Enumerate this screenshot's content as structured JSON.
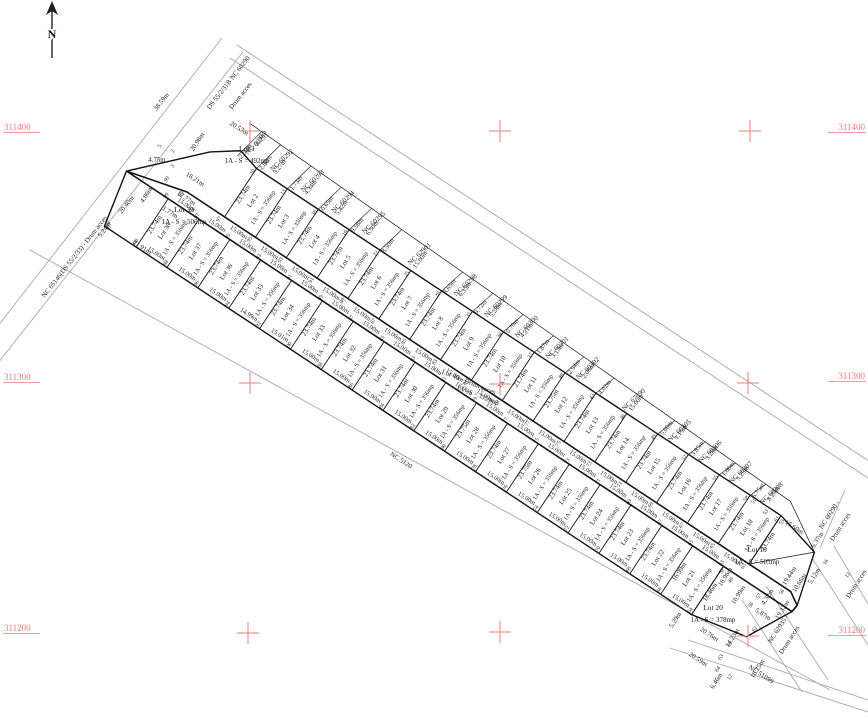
{
  "map": {
    "title": "Cadastral parcel plan",
    "north_label": "N",
    "colors": {
      "red": "#e87e7e",
      "line": "#1a1a1a",
      "faint": "#a8a8a8"
    },
    "grid": {
      "left_labels": [
        {
          "t": "311400",
          "y": 130
        },
        {
          "t": "311300",
          "y": 380
        },
        {
          "t": "311200",
          "y": 631
        }
      ],
      "right_labels": [
        {
          "t": "311400",
          "y": 130
        },
        {
          "t": "311300",
          "y": 379
        },
        {
          "t": "311200",
          "y": 633
        }
      ],
      "crosses": [
        [
          250,
          131
        ],
        [
          500,
          131
        ],
        [
          750,
          131
        ],
        [
          250,
          383
        ],
        [
          500,
          384
        ],
        [
          748,
          383
        ],
        [
          248,
          633
        ],
        [
          500,
          632
        ],
        [
          748,
          636
        ]
      ]
    },
    "central_road": {
      "name": "Lot 40 - Drum acces",
      "area": "1A - S = 3359mp",
      "label_pos": {
        "sx": 468,
        "sy": 384,
        "r": 22
      },
      "area_pos": {
        "sx": 477,
        "sy": 397,
        "r": 22
      }
    },
    "lots_top": [
      {
        "name": "Lot 1",
        "area": "1A - S = 492mp",
        "w": 45,
        "side": "20.98m",
        "front": "18.21m",
        "special": true,
        "lx": 247,
        "ly": 151
      },
      {
        "name": "Lot 2",
        "area": "1A - S = 356mp",
        "w": 37,
        "side": "23.74m",
        "front": "15.00m"
      },
      {
        "name": "Lot 3",
        "area": "1A - S = 356mp",
        "w": 37,
        "side": "23.74m",
        "front": "15.00m"
      },
      {
        "name": "Lot 4",
        "area": "1A - S = 356mp",
        "w": 37,
        "side": "23.74m",
        "front": "15.00m"
      },
      {
        "name": "Lot 5",
        "area": "1A - S = 356mp",
        "w": 37,
        "side": "23.74m",
        "front": "15.00m"
      },
      {
        "name": "Lot 6",
        "area": "1A - S = 356mp",
        "w": 37,
        "side": "23.74m",
        "front": "15.00m"
      },
      {
        "name": "Lot 7",
        "area": "1A - S = 356mp",
        "w": 37,
        "side": "23.74m",
        "front": "15.00m"
      },
      {
        "name": "Lot 8",
        "area": "1A - S = 356mp",
        "w": 37,
        "side": "23.74m",
        "front": "15.00m"
      },
      {
        "name": "Lot 9",
        "area": "1A - S = 356mp",
        "w": 37,
        "side": "23.74m",
        "front": "15.00m"
      },
      {
        "name": "Lot 10",
        "area": "1A - S = 356mp",
        "w": 37,
        "side": "23.74m",
        "front": "15.00m"
      },
      {
        "name": "Lot 11",
        "area": "1A - S = 356mp",
        "w": 37,
        "side": "23.74m",
        "front": "15.00m"
      },
      {
        "name": "Lot 12",
        "area": "1A - S = 356mp",
        "w": 37,
        "side": "23.75m",
        "front": "15.00m"
      },
      {
        "name": "Lot 13",
        "area": "1A - S = 356mp",
        "w": 37,
        "side": "23.74m",
        "front": "15.00m"
      },
      {
        "name": "Lot 14",
        "area": "1A - S = 356mp",
        "w": 37,
        "side": "23.74m",
        "front": "15.00m"
      },
      {
        "name": "Lot 15",
        "area": "1A - S = 356mp",
        "w": 37,
        "side": "23.74m",
        "front": "15.00m"
      },
      {
        "name": "Lot 16",
        "area": "1A - S = 356mp",
        "w": 37,
        "side": "23.74m",
        "front": "15.00m"
      },
      {
        "name": "Lot 17",
        "area": "1A - S = 356mp",
        "w": 37,
        "side": "23.74m",
        "front": "15.00m"
      },
      {
        "name": "Lot 18",
        "area": "1A - S = 356mp",
        "w": 37,
        "side": "23.74m",
        "front": "15.00m"
      },
      {
        "name": "Lot 19",
        "area": "1A - S = 505mp",
        "w": 50,
        "side": "23.74m",
        "front": "15.60m",
        "special": true,
        "lx": 757,
        "ly": 552
      }
    ],
    "lots_bottom": [
      {
        "name": "Lot 39",
        "area": "1A - S = 506mp",
        "w": 50,
        "side": "20.40m",
        "rear": "21.91m",
        "special": true,
        "lx": 184,
        "ly": 212
      },
      {
        "name": "Lot 38",
        "area": "1A - S = 356mp",
        "w": 37,
        "side": "23.74m",
        "rear": "15.00m"
      },
      {
        "name": "Lot 37",
        "area": "1A - S = 356mp",
        "w": 37,
        "side": "23.74m",
        "rear": "15.00m"
      },
      {
        "name": "Lot 36",
        "area": "1A - S = 356mp",
        "w": 37,
        "side": "23.74m",
        "rear": "15.00m"
      },
      {
        "name": "Lot 35",
        "area": "1A - S = 356mp",
        "w": 37,
        "side": "23.74m",
        "rear": "14.99m"
      },
      {
        "name": "Lot 34",
        "area": "1A - S = 356mp",
        "w": 37,
        "side": "23.74m",
        "rear": "15.01m"
      },
      {
        "name": "Lot 33",
        "area": "1A - S = 356mp",
        "w": 37,
        "side": "23.74m",
        "rear": "15.00m"
      },
      {
        "name": "Lot 32",
        "area": "1A - S = 356mp",
        "w": 37,
        "side": "23.74m",
        "rear": "15.00m"
      },
      {
        "name": "Lot 31",
        "area": "1A - S = 356mp",
        "w": 37,
        "side": "23.74m",
        "rear": "15.00m"
      },
      {
        "name": "Lot 30",
        "area": "1A - S = 356mp",
        "w": 37,
        "side": "23.74m",
        "rear": "15.00m"
      },
      {
        "name": "Lot 29",
        "area": "1A - S = 356mp",
        "w": 37,
        "side": "23.74m",
        "rear": "15.00m"
      },
      {
        "name": "Lot 28",
        "area": "1A - S = 356mp",
        "w": 37,
        "side": "23.75m",
        "rear": "15.00m"
      },
      {
        "name": "Lot 27",
        "area": "1A - S = 356mp",
        "w": 37,
        "side": "23.74m",
        "rear": "15.00m"
      },
      {
        "name": "Lot 26",
        "area": "1A - S = 356mp",
        "w": 37,
        "side": "23.75m",
        "rear": "15.00m"
      },
      {
        "name": "Lot 25",
        "area": "1A - S = 356mp",
        "w": 37,
        "side": "23.74m",
        "rear": "15.00m"
      },
      {
        "name": "Lot 24",
        "area": "1A - S = 356mp",
        "w": 37,
        "side": "23.74m",
        "rear": "15.00m"
      },
      {
        "name": "Lot 23",
        "area": "1A - S = 356mp",
        "w": 37,
        "side": "23.74m",
        "rear": "15.00m"
      },
      {
        "name": "Lot 22",
        "area": "1A - S = 356mp",
        "w": 37,
        "side": "23.74m",
        "rear": "15.00m"
      },
      {
        "name": "Lot 21",
        "area": "1A - S = 356mp",
        "w": 37,
        "side": "16.99m",
        "rear": "15.00m"
      },
      {
        "name": "Lot 20",
        "area": "1A - S = 378mp",
        "w": 52,
        "side": "18.46m",
        "rear": "20.59m",
        "special": true,
        "lx": 713,
        "ly": 610
      }
    ],
    "neighbors_top": [
      {
        "nc": "NC 60291",
        "dims": [
          "2.30m"
        ]
      },
      {
        "nc": "NC 60292",
        "dims": [
          "12.80m",
          "3.27m"
        ]
      },
      {
        "nc": "NC 60293",
        "dims": [
          "11.73m",
          "4.34m"
        ]
      },
      {
        "nc": "NC 60294",
        "dims": [
          "10.65m",
          "5.42m"
        ]
      },
      {
        "nc": "NC 60295",
        "dims": [
          "9.58m",
          "6.50m"
        ]
      },
      {
        "nc": "NC 62901",
        "dims": [
          "8.50m",
          "15.00m"
        ]
      },
      {
        "nc": "NC 60298",
        "dims": [
          "8.65m",
          "6.35m"
        ]
      },
      {
        "nc": "NC 60299",
        "dims": [
          "9.72m",
          "5.28m"
        ]
      },
      {
        "nc": "NC 60300",
        "dims": [
          "10.79m",
          "4.21m"
        ]
      },
      {
        "nc": "NC 60301",
        "dims": [
          "11.87m",
          "3.13m"
        ]
      },
      {
        "nc": "NC 60302",
        "dims": [
          "12.94m",
          "2.06m"
        ]
      },
      {
        "nc": "NC 67690",
        "dims": [
          "14.02m",
          "15.00m"
        ]
      },
      {
        "nc": "NC 60305",
        "dims": [
          "15.00m",
          "1.15m"
        ]
      },
      {
        "nc": "NC 60306",
        "dims": [
          "13.85m",
          "3.28m"
        ]
      },
      {
        "nc": "NC 60307",
        "dims": [
          "11.80m",
          "5.25m"
        ]
      },
      {
        "nc": "NC 60308",
        "dims": [
          "6.75m",
          "8.25m"
        ]
      }
    ],
    "road_labels": [
      {
        "t": "DS 55/2/31B NC 60290",
        "sx": 230,
        "sy": 84,
        "r": -52,
        "n": "top-road-label"
      },
      {
        "t": "Drum acces",
        "sx": 242,
        "sy": 97,
        "r": -52,
        "n": "top-road-label-2"
      },
      {
        "t": "NC 65146(DS 55/2/33) - Drum acces",
        "sx": 76,
        "sy": 258,
        "r": -52,
        "n": "left-road-label"
      },
      {
        "t": "NC 5120",
        "sx": 400,
        "sy": 462,
        "r": 33,
        "n": "bottom-road-label"
      },
      {
        "t": "NC 51099",
        "sx": 760,
        "sy": 676,
        "r": 33,
        "n": "bottom-right-road-label"
      },
      {
        "t": "NC 60290 -",
        "sx": 831,
        "sy": 516,
        "r": -57,
        "n": "right-road-label"
      },
      {
        "t": "Drum acces",
        "sx": 842,
        "sy": 528,
        "r": -57,
        "n": "right-road-label-2"
      },
      {
        "t": "NC 62935 -",
        "sx": 780,
        "sy": 630,
        "r": -57,
        "n": "right-road-label-3"
      },
      {
        "t": "Drum acces",
        "sx": 791,
        "sy": 641,
        "r": -57,
        "n": "right-road-label-4"
      },
      {
        "t": "Drum acces",
        "sx": 858,
        "sy": 585,
        "r": -57,
        "n": "right-road-label-5"
      }
    ],
    "misc_dims": [
      {
        "t": "38.59m",
        "sx": 163,
        "sy": 103,
        "r": -52
      },
      {
        "t": "20.40m",
        "sx": 128,
        "sy": 206,
        "r": -52
      },
      {
        "t": "4.86m",
        "sx": 148,
        "sy": 196,
        "r": -57
      },
      {
        "t": "5.24m",
        "sx": 106,
        "sy": 231,
        "r": -52
      },
      {
        "t": "21.91m",
        "sx": 141,
        "sy": 249,
        "r": 33
      },
      {
        "t": "1.77m",
        "sx": 169,
        "sy": 214,
        "r": 33
      },
      {
        "t": "12.77m",
        "sx": 185,
        "sy": 200,
        "r": 33
      },
      {
        "t": "18.21m",
        "sx": 194,
        "sy": 181,
        "r": 33
      },
      {
        "t": "4.75m",
        "sx": 157,
        "sy": 162,
        "r": 0
      },
      {
        "t": "20.98m",
        "sx": 199,
        "sy": 143,
        "r": -57
      },
      {
        "t": "20.57m",
        "sx": 238,
        "sy": 130,
        "r": 33
      },
      {
        "t": "2.30m",
        "sx": 262,
        "sy": 139,
        "r": -57
      },
      {
        "t": "15.60m",
        "sx": 793,
        "sy": 529,
        "r": 33
      },
      {
        "t": "6.37m",
        "sx": 819,
        "sy": 541,
        "r": -57
      },
      {
        "t": "19.44m",
        "sx": 791,
        "sy": 577,
        "r": -57
      },
      {
        "t": "16.96m",
        "sx": 727,
        "sy": 578,
        "r": -57
      },
      {
        "t": "16.99m",
        "sx": 740,
        "sy": 596,
        "r": -57
      },
      {
        "t": "10.66m",
        "sx": 801,
        "sy": 584,
        "r": -57
      },
      {
        "t": "5.12m",
        "sx": 816,
        "sy": 577,
        "r": -57
      },
      {
        "t": "19.32m",
        "sx": 784,
        "sy": 611,
        "r": -57
      },
      {
        "t": "4.32m",
        "sx": 769,
        "sy": 598,
        "r": -57
      },
      {
        "t": "5.87m",
        "sx": 762,
        "sy": 616,
        "r": 33
      },
      {
        "t": "14.23m",
        "sx": 734,
        "sy": 639,
        "r": -57
      },
      {
        "t": "20.76m",
        "sx": 708,
        "sy": 636,
        "r": 33
      },
      {
        "t": "20.59m",
        "sx": 697,
        "sy": 661,
        "r": 33
      },
      {
        "t": "6.46m",
        "sx": 718,
        "sy": 682,
        "r": -57
      },
      {
        "t": "5.29m",
        "sx": 677,
        "sy": 621,
        "r": -57
      },
      {
        "t": "18.25m",
        "sx": 759,
        "sy": 670,
        "r": -57
      }
    ],
    "point_numbers": {
      "road_north": [
        "99",
        "97",
        "95",
        "93",
        "91",
        "89",
        "87",
        "85",
        "83",
        "81",
        "79",
        "77",
        "75",
        "73",
        "71",
        "69",
        "67",
        "65",
        "63"
      ],
      "road_south": [
        "99",
        "97",
        "95",
        "93",
        "91",
        "89",
        "87",
        "85",
        "83",
        "81",
        "79",
        "77",
        "75",
        "73",
        "71",
        "69",
        "67",
        "65",
        "63"
      ],
      "top_rear": [
        "10",
        "13",
        "16",
        "19",
        "22",
        "25",
        "28",
        "31",
        "34",
        "37",
        "40",
        "43",
        "46",
        "49",
        "52",
        "55",
        "58",
        "61"
      ],
      "bottom_rear": [
        "100",
        "98",
        "96",
        "94",
        "92",
        "90",
        "88",
        "86",
        "84",
        "82",
        "80",
        "78",
        "76",
        "74",
        "72",
        "70",
        "68",
        "66",
        "64"
      ],
      "extras": [
        {
          "t": "2",
          "sx": 174,
          "sy": 152
        },
        {
          "t": "3",
          "sx": 174,
          "sy": 167
        },
        {
          "t": "5",
          "sx": 161,
          "sy": 147
        },
        {
          "t": "99",
          "sx": 168,
          "sy": 180
        },
        {
          "t": "10",
          "sx": 109,
          "sy": 225
        },
        {
          "t": "49",
          "sx": 732,
          "sy": 581
        },
        {
          "t": "52",
          "sx": 723,
          "sy": 572
        },
        {
          "t": "51",
          "sx": 755,
          "sy": 502
        },
        {
          "t": "53",
          "sx": 767,
          "sy": 513
        },
        {
          "t": "55",
          "sx": 783,
          "sy": 523
        },
        {
          "t": "16",
          "sx": 827,
          "sy": 563
        },
        {
          "t": "12",
          "sx": 849,
          "sy": 576
        },
        {
          "t": "56",
          "sx": 783,
          "sy": 593
        },
        {
          "t": "57",
          "sx": 760,
          "sy": 597
        },
        {
          "t": "58",
          "sx": 752,
          "sy": 606
        },
        {
          "t": "62",
          "sx": 756,
          "sy": 630
        },
        {
          "t": "61",
          "sx": 731,
          "sy": 645
        },
        {
          "t": "63",
          "sx": 722,
          "sy": 658
        },
        {
          "t": "64",
          "sx": 719,
          "sy": 670
        },
        {
          "t": "12",
          "sx": 731,
          "sy": 678
        }
      ]
    }
  }
}
